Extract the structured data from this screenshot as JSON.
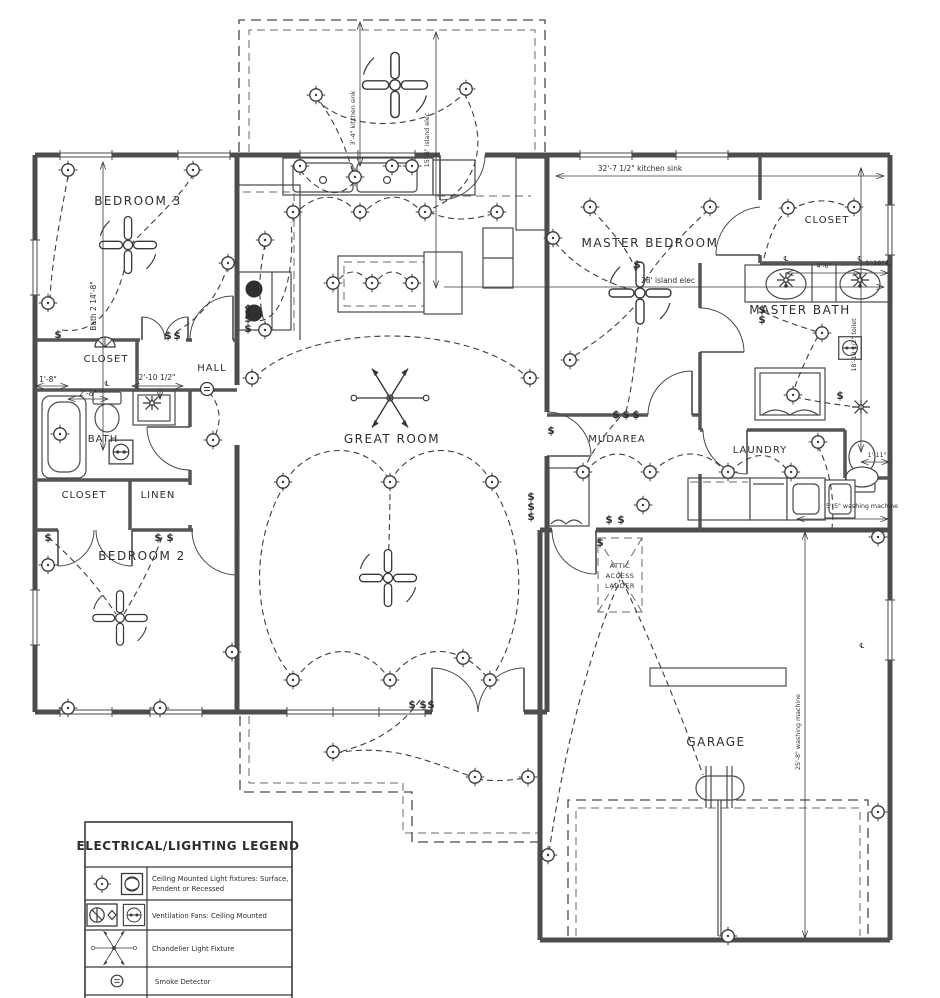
{
  "plan": {
    "rooms": {
      "bedroom3": "BEDROOM 3",
      "closet1": "CLOSET",
      "hall": "HALL",
      "bath": "BATH",
      "closet2": "CLOSET",
      "linen": "LINEN",
      "bedroom2": "BEDROOM 2",
      "great_room": "GREAT ROOM",
      "master_bedroom": "MASTER BEDROOM",
      "master_closet": "CLOSET",
      "master_bath": "MASTER BATH",
      "mudarea": "MUDAREA",
      "laundry": "LAUNDRY",
      "garage": "GARAGE"
    },
    "attic": {
      "line1": "ATTIC",
      "line2": "ACCESS",
      "line3": "LADDER"
    },
    "dims": {
      "bath2_height": "Bath 2 14'-8\"",
      "d_1_8": "1'-8\"",
      "d_2_8": "2'-8\"",
      "d_2_10": "2'-10 1/2\"",
      "kitchen_sink_v": "3'-4\" kitchen sink",
      "island_elec_v": "15'-6\" island elec",
      "kitchen_sink_h": "32'-7 1/2\" kitchen sink",
      "island_elec_h": "28' island elec",
      "d_4_6": "4'-6\"",
      "d_1_10": "1'-10\"",
      "toilet_v": "18'-10 1/2\" toilet",
      "d_1_11": "1'-11\"",
      "washer_h": "5'-5\" washing machine",
      "washer_v": "25'-8\" washing machine"
    },
    "symbols": {
      "switch": "$",
      "centerline": "℄"
    }
  },
  "legend": {
    "title": "ELECTRICAL/LIGHTING LEGEND",
    "rows": [
      {
        "line1": "Ceiling Mounted Light fixtures: Surface,",
        "line2": "Pendent or Recessed"
      },
      {
        "line1": "Ventilation Fans: Ceiling Mounted",
        "line2": ""
      },
      {
        "line1": "Chandelier Light Fixture",
        "line2": ""
      },
      {
        "line1": "Smoke Detector",
        "line2": ""
      }
    ]
  }
}
